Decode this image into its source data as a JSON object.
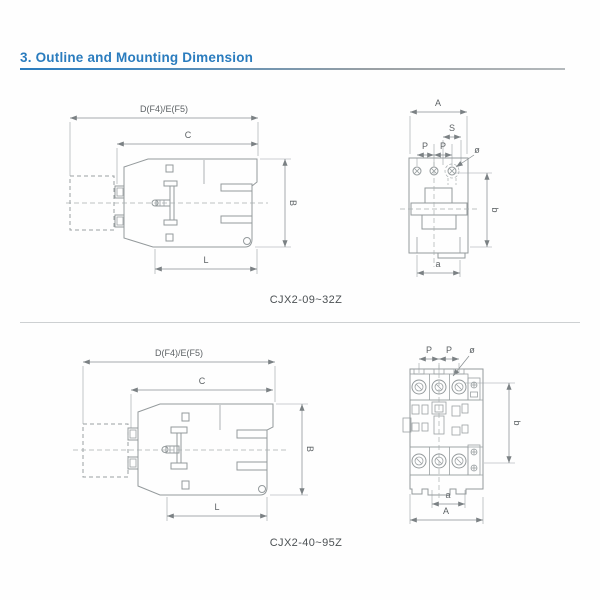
{
  "page": {
    "title": "3. Outline and Mounting Dimension"
  },
  "colors": {
    "accent": "#2a7cbe",
    "drawing_line": "#949a9c",
    "dim_text": "#5d6265"
  },
  "sections": [
    {
      "model_label": "CJX2-09~32Z",
      "side_view": {
        "dim_total_width": "D(F4)/E(F5)",
        "dim_body_width": "C",
        "dim_height": "B",
        "dim_lower_width": "L"
      },
      "front_view": {
        "dim_total_width": "A",
        "dim_slot_width": "S",
        "dim_hole_pitch_left": "P",
        "dim_hole_pitch_right": "P",
        "dim_hole_dia": "ø",
        "dim_mount_height": "b",
        "dim_mount_width": "a"
      }
    },
    {
      "model_label": "CJX2-40~95Z",
      "side_view": {
        "dim_total_width": "D(F4)/E(F5)",
        "dim_body_width": "C",
        "dim_height": "B",
        "dim_lower_width": "L"
      },
      "front_view": {
        "dim_total_width": "A",
        "dim_hole_pitch_left": "P",
        "dim_hole_pitch_right": "P",
        "dim_hole_dia": "ø",
        "dim_mount_height": "b",
        "dim_mount_width": "a"
      }
    }
  ]
}
